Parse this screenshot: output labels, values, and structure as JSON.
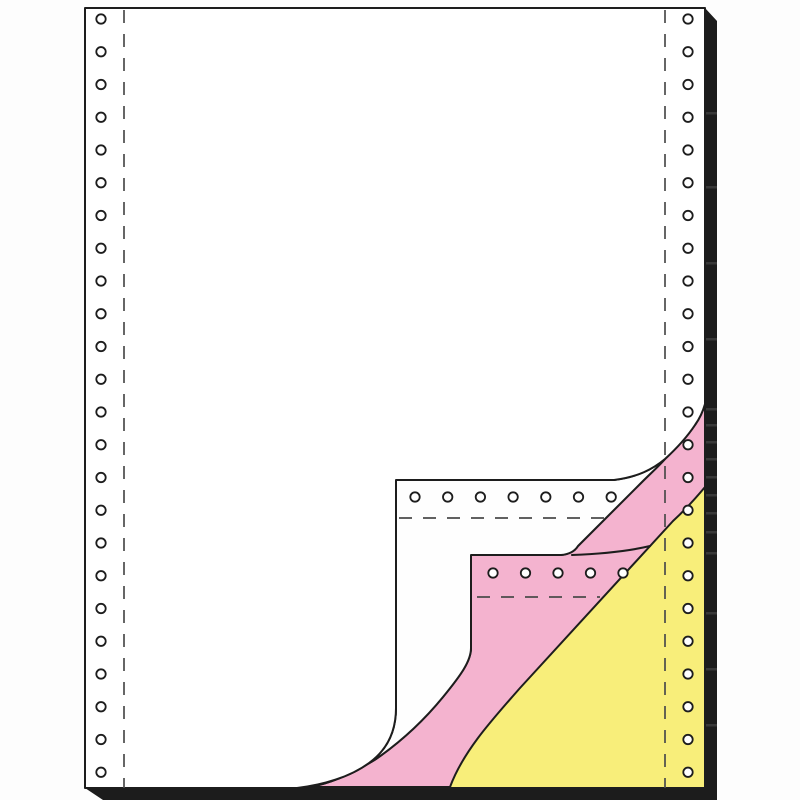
{
  "scene": {
    "description": "Three-ply carbonless continuous form paper (tractor-feed fanfold) shown as a product illustration; the bottom-right corner is peeled back revealing a white top sheet, a pink middle copy sheet and a yellow bottom copy sheet, with punched tractor holes and dashed perforation lines on both margins and a black drop shadow at the right and bottom edges",
    "background_color": "#fdfdfd",
    "line_color": "#1d1d1d",
    "dash_color": "#4b4b4b",
    "shadow_color": "#1c1c1c",
    "shadow_streak_color": "#3d3d3d"
  },
  "sheets": {
    "top_white_color": "#ffffff",
    "second_white_color": "#fefefe",
    "pink_color": "#f4b3cf",
    "yellow_color": "#f8ee7a",
    "hole_fill_color": "#ffffff"
  },
  "tractor_feed": {
    "left_hole_count": 24,
    "right_hole_count": 24,
    "second_sheet_hole_count": 7,
    "pink_sheet_hole_count": 5
  }
}
